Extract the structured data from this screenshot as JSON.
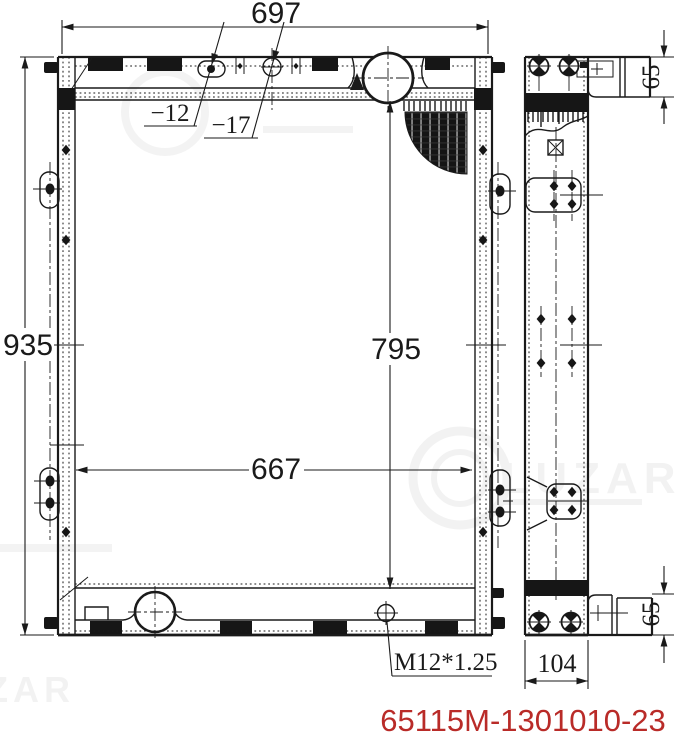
{
  "drawing": {
    "type": "radiator-technical-drawing",
    "part_number": {
      "text": "65115M-1301010-23",
      "color": "#b92b28"
    },
    "dimensions": {
      "overall_width": "697",
      "overall_height": "935",
      "core_height": "795",
      "core_width": "667",
      "depth": "104",
      "bracket_offset_top": "65",
      "bracket_offset_bottom": "65",
      "hole_small": "−12",
      "hole_large": "−17",
      "drain_plug_thread": "M12*1.25"
    },
    "watermark": {
      "brand": "LUZAR"
    },
    "line_color": "#1a1a1a"
  }
}
